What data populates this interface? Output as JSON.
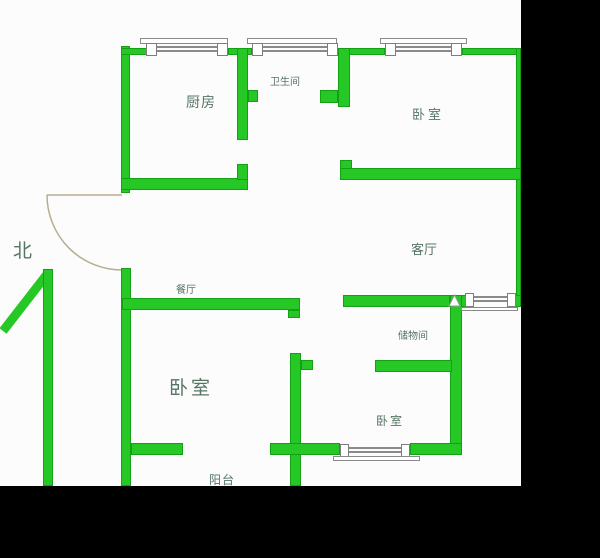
{
  "plan": {
    "title": "apartment-floor-plan",
    "north_label": "北",
    "rooms": {
      "kitchen": "厨房",
      "bathroom": "卫生间",
      "bedroom_top_right": "卧室",
      "living_room": "客厅",
      "dining_room": "餐厅",
      "storage_room": "储物间",
      "bedroom_left": "卧室",
      "bedroom_bottom_right": "卧室",
      "balcony": "阳台"
    },
    "colors": {
      "wall_green": "#25c825",
      "wall_edge_green": "#14a014",
      "mask_black": "#000000",
      "label_text": "#567565",
      "door_line": "#b5ae8e",
      "window_line": "#8a8a8a"
    }
  }
}
